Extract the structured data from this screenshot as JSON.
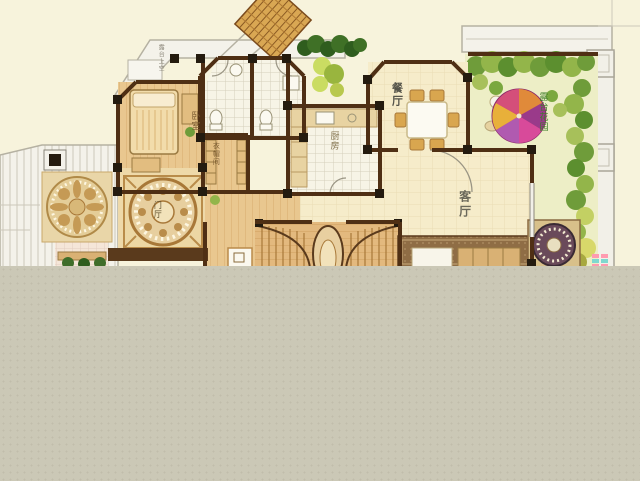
{
  "title": "residential-floor-plan",
  "labels": {
    "dining_room": "餐厅",
    "living_room": "客厅",
    "kitchen": "厨房",
    "bedroom": "卧室",
    "cloakroom": "衣帽间",
    "foyer": "门厅",
    "terrace_garden": "露台花园",
    "roof_annotation": "露台上空"
  },
  "colors": {
    "background": "#f7f3dc",
    "masked_region": "#cbc8b6",
    "wall": "#4f2f14",
    "wall_node": "#241b0f",
    "wood_floor": "#e9c78f",
    "tile_floor": "#f7f4e6",
    "dining_floor": "#f6ecca",
    "lawn": "#edeec6",
    "shrub_green": "#5c8f2f",
    "shrub_yellow_green": "#c3d063",
    "parasol_pink": "#d84a9a",
    "parasol_purple": "#9a3a8a",
    "parasol_orange": "#e08a3a",
    "carpet_brown": "#8f6d45",
    "trellis_wood": "#d9a753",
    "roof_white": "#f4f2ea"
  }
}
